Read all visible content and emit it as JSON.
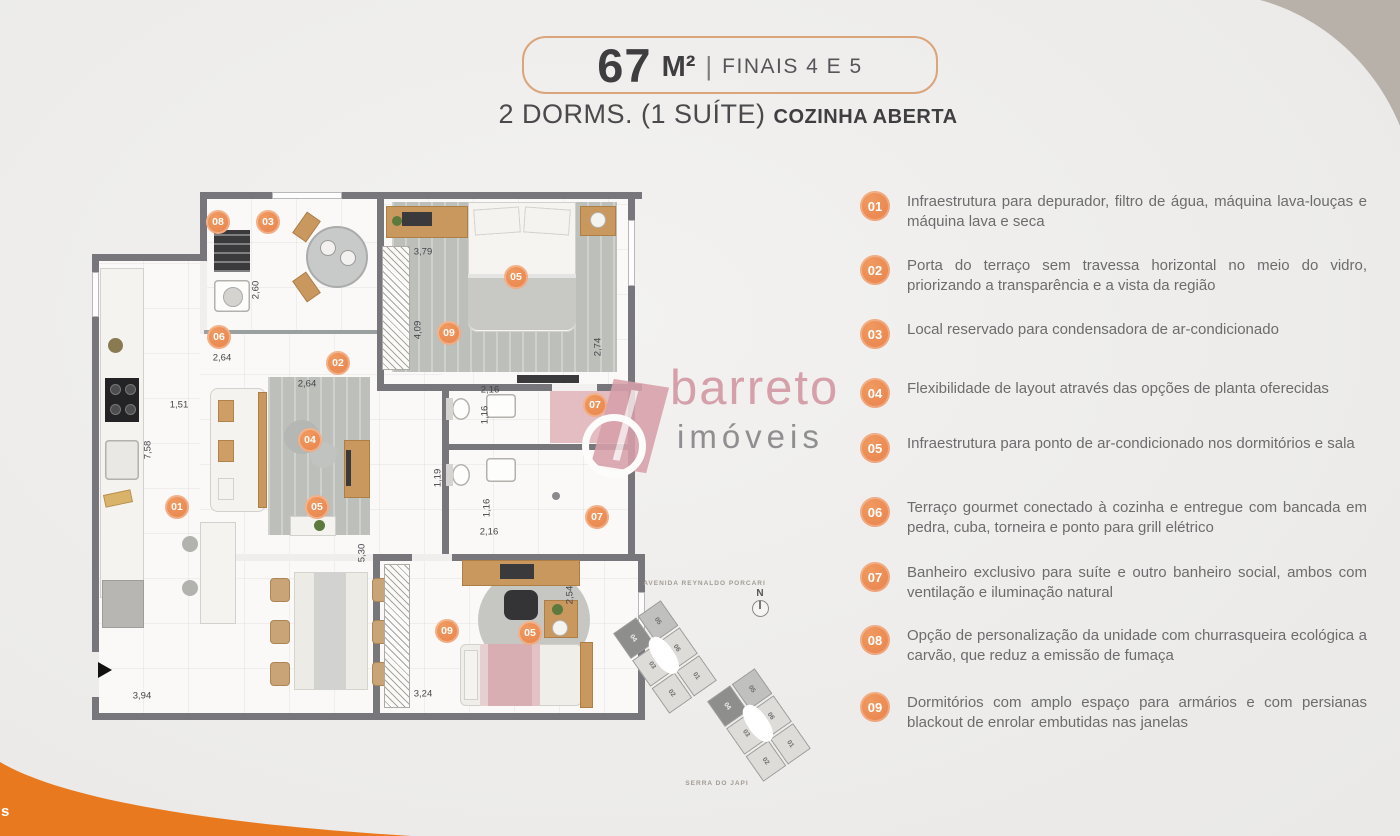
{
  "header": {
    "area_value": "67",
    "area_unit": "M²",
    "separator": "|",
    "finals": "FINAIS 4 E 5",
    "subtitle_main": "2 DORMS. (1 SUÍTE) ",
    "subtitle_bold": "COZINHA ABERTA"
  },
  "features": {
    "items": [
      {
        "number": "01",
        "text": "Infraestrutura para depurador, filtro de água, máquina lava-louças e máquina lava e seca"
      },
      {
        "number": "02",
        "text": "Porta do terraço sem travessa horizontal no meio do vidro, priorizando a transparência e a vista da região"
      },
      {
        "number": "03",
        "text": "Local reservado para condensadora de ar-condicionado"
      },
      {
        "number": "04",
        "text": "Flexibilidade de layout através das opções de planta oferecidas"
      },
      {
        "number": "05",
        "text": "Infraestrutura para ponto de ar-condicionado nos dormitórios e sala"
      },
      {
        "number": "06",
        "text": "Terraço gourmet conectado à cozinha e entregue com bancada em pedra, cuba, torneira e ponto para grill elétrico"
      },
      {
        "number": "07",
        "text": "Banheiro exclusivo para suíte e outro banheiro social, ambos com ventilação e iluminação natural"
      },
      {
        "number": "08",
        "text": "Opção de personalização da unidade com churrasqueira ecológica a carvão, que reduz a emissão de fumaça"
      },
      {
        "number": "09",
        "text": "Dormitórios com amplo espaço para armários e com persianas blackout de enrolar embutidas nas janelas"
      }
    ]
  },
  "plan": {
    "markers": [
      "08",
      "03",
      "06",
      "02",
      "05",
      "09",
      "01",
      "04",
      "05",
      "07",
      "07",
      "09",
      "05"
    ],
    "dims": [
      "2,60",
      "2,64",
      "2,64",
      "1,51",
      "7,58",
      "3,79",
      "4,09",
      "2,74",
      "2,16",
      "1,16",
      "1,19",
      "1,16",
      "2,16",
      "5,30",
      "2,54",
      "3,24",
      "3,94"
    ]
  },
  "keyplan": {
    "street": "AVENIDA REYNALDO PORCARI",
    "mountain": "SERRA DO JAPI",
    "compass": "N",
    "units": [
      "04",
      "05",
      "03",
      "06",
      "02",
      "01"
    ]
  },
  "watermark": {
    "name": "barreto",
    "subtitle": "imóveis"
  },
  "corner": {
    "fragment": "s"
  },
  "colors": {
    "accent": "#EC8C55",
    "corner_orange": "#E8791F",
    "corner_taupe": "#B8B1AA",
    "badge_border": "#DBA57C",
    "wall": "#76767B",
    "logo_pink": "#D5A0AA"
  }
}
